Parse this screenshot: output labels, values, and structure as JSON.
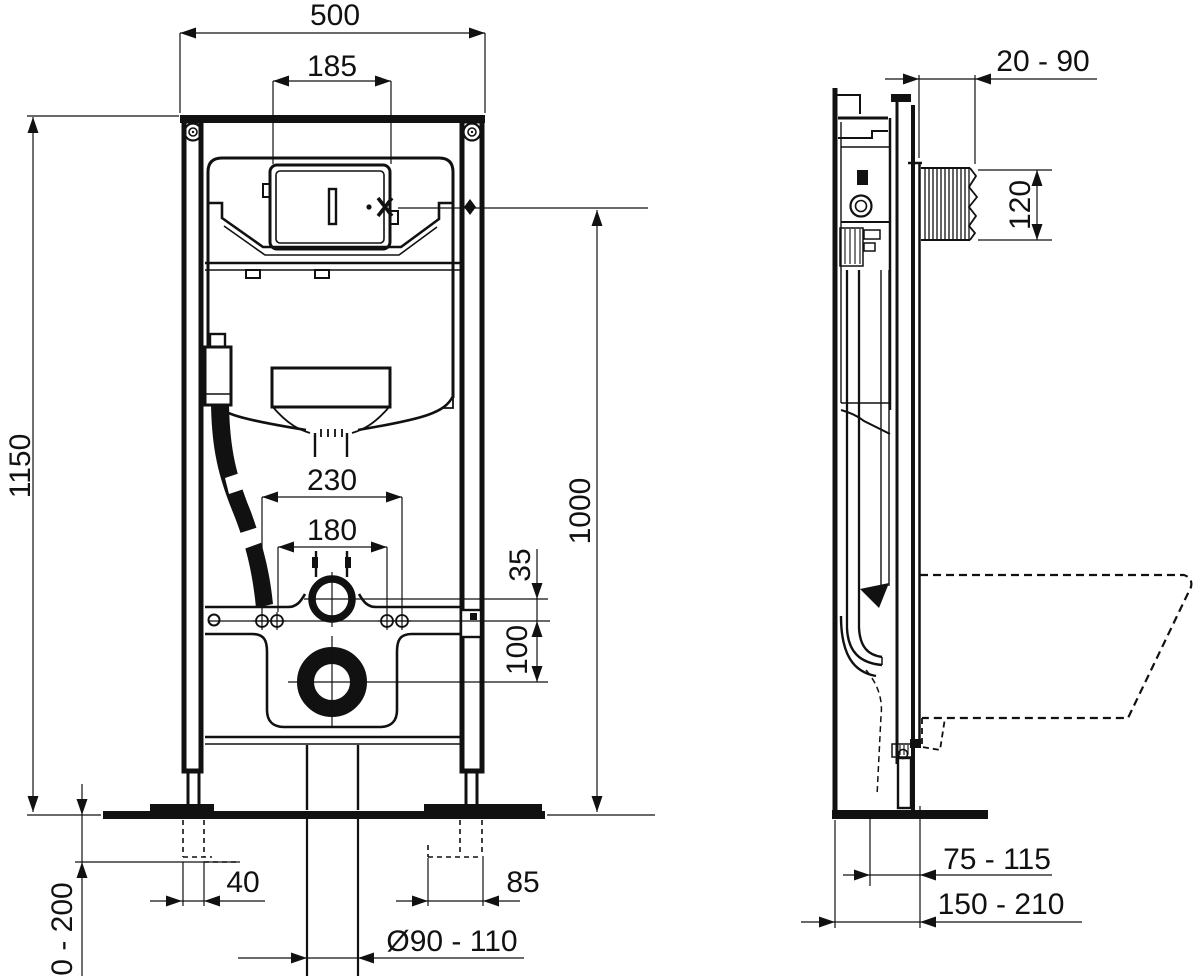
{
  "page": {
    "background_color": "#ffffff",
    "line_color": "#111111"
  },
  "front_view": {
    "dims": {
      "frame_width": "500",
      "flush_plate_opening_width": "185",
      "frame_height": "1150",
      "flush_bend_height": "1000",
      "fixing_span_outer": "230",
      "fixing_span_inner": "180",
      "flush_pipe_to_bracket": "35",
      "bracket_to_outlet": "100",
      "left_foot_offset": "40",
      "right_foot_offset": "85",
      "drain_pipe_diameter": "Ø90 - 110",
      "foot_height_adjustment": "0 - 200"
    }
  },
  "side_view": {
    "dims": {
      "wall_finish_range": "20 - 90",
      "outlet_sleeve_length": "120",
      "outlet_projection_range": "75 - 115",
      "frame_depth_range": "150 - 210"
    }
  }
}
